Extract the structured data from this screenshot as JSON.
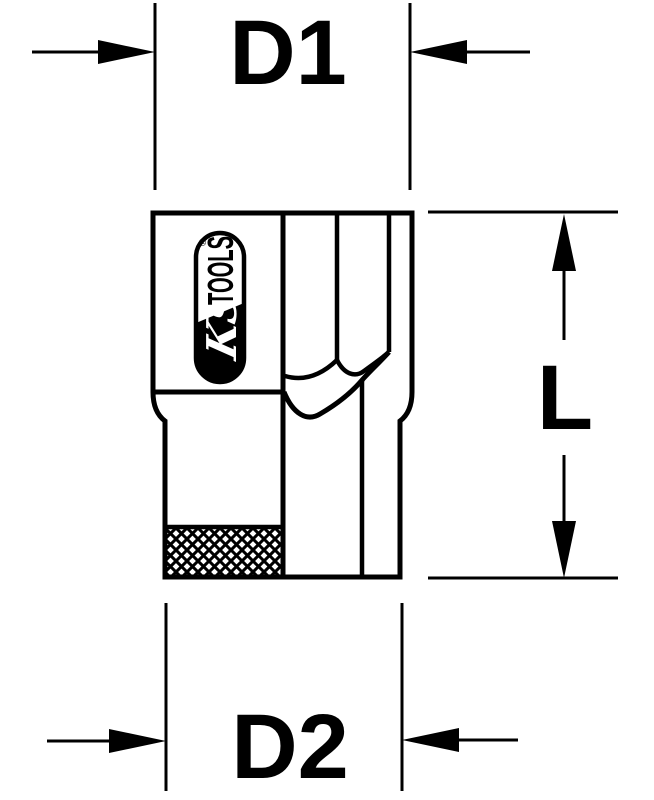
{
  "diagram": {
    "kind": "technical dimension drawing",
    "labels": {
      "top_width": "D1",
      "side_length": "L",
      "bottom_width": "D2"
    },
    "logo": {
      "script": "KS",
      "text": "TOOLS",
      "registered": "®"
    },
    "colors": {
      "line": "#000000",
      "background": "#ffffff"
    }
  }
}
